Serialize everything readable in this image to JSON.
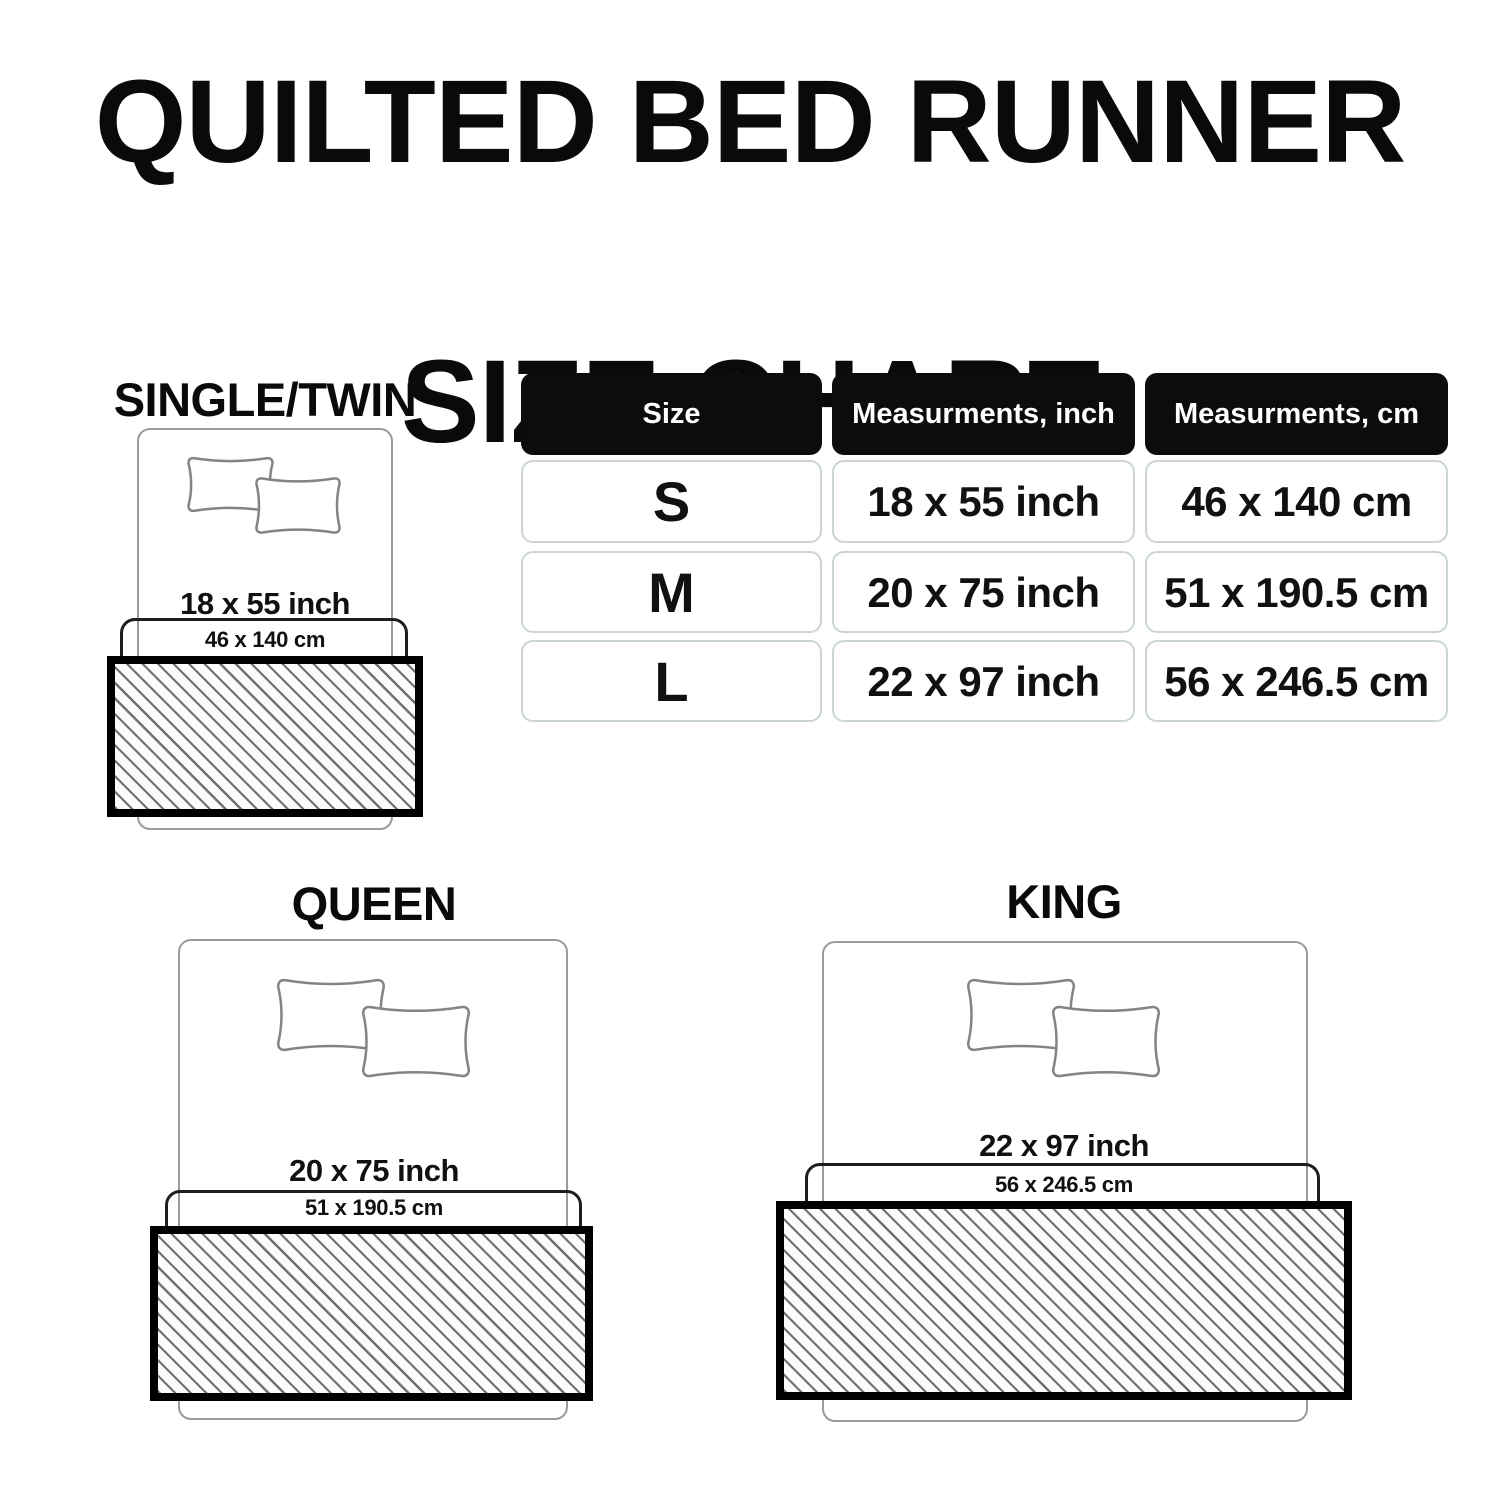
{
  "title": {
    "line1": "QUILTED BED RUNNER",
    "line2": "SIZE CHART"
  },
  "table": {
    "headers": [
      "Size",
      "Measurments, inch",
      "Measurments, cm"
    ],
    "rows": [
      {
        "size": "S",
        "inch": "18 x 55 inch",
        "cm": "46 x 140 cm"
      },
      {
        "size": "M",
        "inch": "20 x 75 inch",
        "cm": "51 x 190.5 cm"
      },
      {
        "size": "L",
        "inch": "22 x 97 inch",
        "cm": "56 x 246.5 cm"
      }
    ]
  },
  "diagrams": [
    {
      "title": "SINGLE/TWIN",
      "inch": "18 x 55 inch",
      "cm": "46 x 140 cm"
    },
    {
      "title": "QUEEN",
      "inch": "20 x 75 inch",
      "cm": "51 x 190.5 cm"
    },
    {
      "title": "KING",
      "inch": "22 x 97 inch",
      "cm": "56 x 246.5 cm"
    }
  ],
  "colors": {
    "page-bg": "#ffffff",
    "ink": "#111111",
    "title-ink": "#0a0a0a",
    "hdr-bg": "#0c0c0c",
    "hdr-text": "#ffffff",
    "cell-border": "#ccd5d5",
    "bed-line": "#9b9b9b",
    "pillow-line": "#848484",
    "inner-line": "#1e1e1e",
    "runner-border": "#000000",
    "hatch-line": "#707070",
    "hatch-bg": "#fbfbfa"
  }
}
